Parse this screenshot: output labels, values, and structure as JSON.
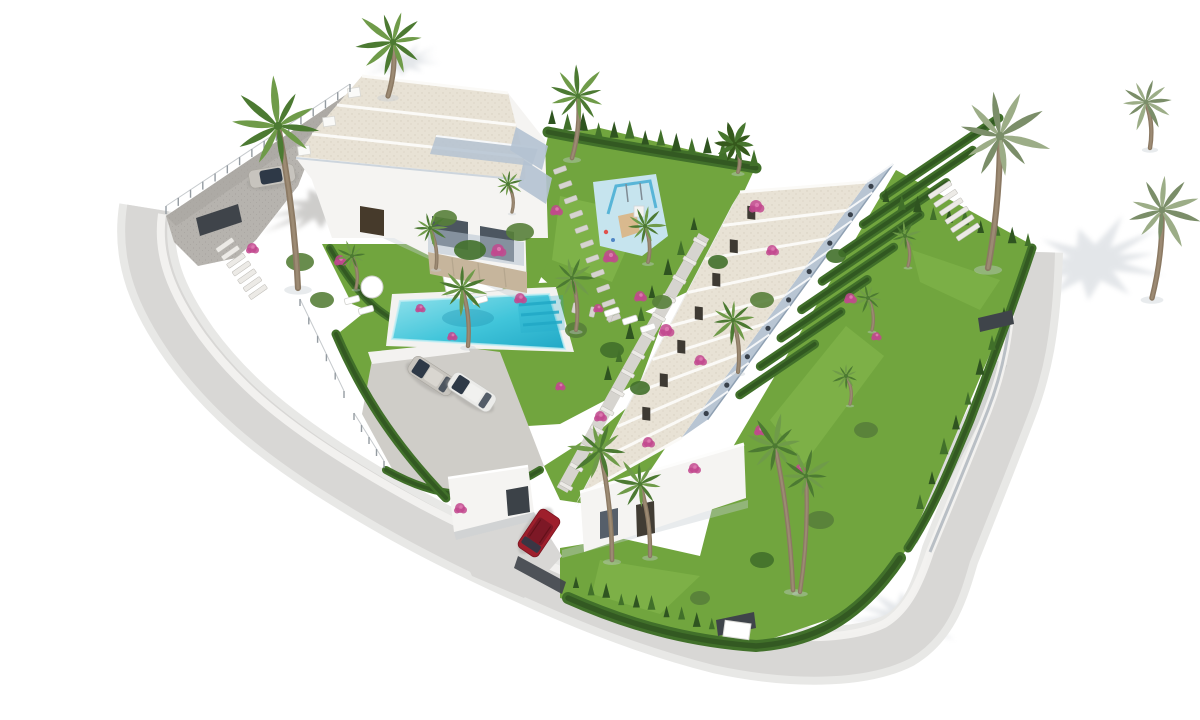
{
  "scene": {
    "type": "architectural-3d-render",
    "description": "Aerial three-quarter view render of a white Mediterranean residential development on an irregular sloping plot surrounded by curved light-grey roads on a pure white background.",
    "background": "#ffffff",
    "lighting": "soft daylight, shadows cast toward the east"
  },
  "objects": {
    "villa_block": {
      "label": "detached villa block",
      "units": 3,
      "roof": "flat sand-gravel roofs",
      "features": [
        "glass balconies",
        "dark entry door",
        "stone retaining wall"
      ]
    },
    "townhouse_row": {
      "label": "terraced townhouse row",
      "units": 9,
      "roof": "sloped sand-gravel roofs",
      "features": [
        "stepped terraces with glass rails",
        "private hedged rear gardens",
        "end gable wall",
        "garage annex"
      ]
    },
    "pool": {
      "label": "communal swimming pool",
      "color": "turquoise",
      "steps": 3,
      "deck": "white"
    },
    "playground": {
      "label": "children's playground",
      "pad_color": "light blue",
      "equipment": [
        "swing frame",
        "wooden tower",
        "slide"
      ]
    },
    "vehicles": [
      {
        "label": "silver sedan",
        "location": "pool parking pad"
      },
      {
        "label": "white sedan",
        "location": "pool parking pad"
      },
      {
        "label": "silver car",
        "location": "upper gravel parking"
      },
      {
        "label": "red SUV",
        "location": "townhouse driveway"
      }
    ],
    "vegetation": {
      "palm_count": 21,
      "cypress_hedges": true,
      "bougainvillea_flowers": true
    },
    "site": {
      "gates": 4,
      "fences": "glass balustrade with posts",
      "parking_areas": 2
    }
  },
  "palette": {
    "bg": "#ffffff",
    "road": "#d8d7d5",
    "road_light": "#e8e8e6",
    "road_dark": "#bfc1c1",
    "curb": "#f3f2f0",
    "wall_line": "#b9bfc5",
    "gravel": "#b6b3ae",
    "gravel_dot": "#a7a49f",
    "pad": "#cfcdc8",
    "wall_white": "#f5f4f2",
    "wall_shade": "#dfdedb",
    "grass": "#71a53e",
    "grass_light": "#8cbf52",
    "grass_dark": "#5c8f33",
    "hedge": "#41702a",
    "hedge_dark": "#2f5420",
    "bush": "#587f3a",
    "roof_sand": "#e8e2d5",
    "roof_dot": "#d7cfc0",
    "roof_edge": "#fbfaf7",
    "eave": "#c3ccd6",
    "terrace": "#b4c2d1",
    "glass": "#8ba0b5",
    "pool_light": "#93e2ec",
    "pool": "#41c5da",
    "pool_deep": "#21a8c6",
    "play_pad": "#c6e4ee",
    "play_frame": "#58b5d7",
    "slide_tan": "#d9b98e",
    "trunk": "#8b7963",
    "trunk_light": "#a8967e",
    "frond": "#6f9b49",
    "frond_dark": "#4c7a32",
    "frond_gray": "#9cad87",
    "frond_gray_dark": "#7b8e69",
    "banana": "#47762e",
    "banana_dark": "#35591c",
    "flower": "#c2488e",
    "flower_light": "#e07ab2",
    "car_silver": "#c7c4be",
    "car_white": "#ebebe9",
    "car_red": "#9e1f2c",
    "car_red_dark": "#7d1826",
    "car_glass": "#2e3947",
    "car_roof": "#d9d6d0",
    "gate": "#3f444a",
    "door": "#463a2b",
    "stone": "#d6d4cf",
    "step_white": "#eceae6",
    "stone_tan": "#c6b59c",
    "shadow": "#c6ccd3",
    "shadow_dark": "#9a9894"
  },
  "geometry": {
    "shadow_stars": [
      {
        "x": 1093,
        "y": 262,
        "rx": 78,
        "ry": 42,
        "rot": -8
      },
      {
        "x": 906,
        "y": 618,
        "rx": 58,
        "ry": 30,
        "rot": 6
      },
      {
        "x": 322,
        "y": 206,
        "rx": 62,
        "ry": 24,
        "rot": -18,
        "dark": true
      },
      {
        "x": 404,
        "y": 62,
        "rx": 40,
        "ry": 15,
        "rot": -12
      }
    ],
    "townhouses": {
      "f0": [
        740,
        192
      ],
      "fstep": [
        -17.5,
        33.5
      ],
      "g0": [
        867,
        182
      ],
      "gstep": [
        -20.6,
        28.4
      ],
      "units": 9,
      "terrace": [
        26,
        -18
      ],
      "doors": 7
    },
    "villa_fascias": [
      [
        [
          362,
          76
        ],
        [
          508,
          93
        ]
      ],
      [
        [
          337,
          105
        ],
        [
          516,
          125
        ]
      ],
      [
        [
          312,
          134
        ],
        [
          524,
          157
        ]
      ],
      [
        [
          296,
          158
        ],
        [
          526,
          181
        ]
      ]
    ],
    "dividers": {
      "start": [
        884,
        196
      ],
      "step": [
        -20.6,
        28.4
      ],
      "n": 8,
      "dir": [
        115,
        -78
      ],
      "shrink": 0.05
    },
    "hedgerows": [
      {
        "d": "M 548,132 C 640,150 700,158 756,168",
        "w": 11
      },
      {
        "d": "M 1032,248 C 1014,302 992,362 970,420 C 950,468 932,512 908,548",
        "w": 9
      },
      {
        "d": "M 568,598 C 640,630 700,642 756,646 C 812,642 858,620 900,558",
        "w": 12
      },
      {
        "d": "M 330,248 C 360,300 382,318 420,332",
        "w": 8
      },
      {
        "d": "M 386,470 C 436,498 482,506 540,470",
        "w": 8
      },
      {
        "d": "M 336,334 C 360,390 392,442 446,498",
        "w": 9
      }
    ],
    "cypress": [
      {
        "a": [
          552,
          126
        ],
        "b": [
          754,
          164
        ],
        "n": 14,
        "s": 10
      },
      {
        "a": [
          886,
          204
        ],
        "b": [
          1028,
          246
        ],
        "n": 10,
        "s": 9
      },
      {
        "a": [
          576,
          590
        ],
        "b": [
          742,
          638
        ],
        "n": 12,
        "s": 8
      },
      {
        "a": [
          1004,
          322
        ],
        "b": [
          920,
          510
        ],
        "n": 8,
        "s": 9
      },
      {
        "a": [
          652,
          300
        ],
        "b": [
          608,
          380
        ],
        "n": 5,
        "s": 9
      },
      {
        "a": [
          694,
          232
        ],
        "b": [
          668,
          276
        ],
        "n": 3,
        "s": 9
      }
    ],
    "stones": [
      {
        "a": [
          560,
          170
        ],
        "b": [
          614,
          318
        ],
        "n": 11,
        "w": 13,
        "h": 5,
        "c": "stone"
      },
      {
        "a": [
          540,
          300
        ],
        "b": [
          610,
          316
        ],
        "n": 5,
        "w": 10,
        "h": 5,
        "c": "stone"
      },
      {
        "a": [
          940,
          190
        ],
        "b": [
          968,
          232
        ],
        "n": 6,
        "w": 26,
        "h": 5,
        "c": "step_white"
      },
      {
        "a": [
          700,
          242
        ],
        "b": [
          566,
          486
        ],
        "n": 14,
        "w": 14,
        "h": 4,
        "c": "step_white"
      },
      {
        "a": [
          225,
          245
        ],
        "b": [
          258,
          292
        ],
        "n": 7,
        "w": 20,
        "h": 5,
        "c": "step_white"
      },
      {
        "a": [
          706,
          286
        ],
        "b": [
          752,
          246
        ],
        "n": 5,
        "w": 12,
        "h": 5,
        "c": "stone"
      }
    ],
    "posts": [
      {
        "a": [
          166,
          214
        ],
        "b": [
          350,
          92
        ],
        "n": 16,
        "h": 8
      },
      {
        "a": [
          354,
          420
        ],
        "b": [
          384,
          468
        ],
        "n": 5,
        "h": 7
      },
      {
        "a": [
          300,
          306
        ],
        "b": [
          344,
          398
        ],
        "n": 6,
        "h": 7
      }
    ],
    "flowers": [
      {
        "x": 498,
        "y": 250,
        "r": 6
      },
      {
        "x": 520,
        "y": 298,
        "r": 5
      },
      {
        "x": 556,
        "y": 210,
        "r": 5
      },
      {
        "x": 610,
        "y": 256,
        "r": 6
      },
      {
        "x": 640,
        "y": 296,
        "r": 5
      },
      {
        "x": 666,
        "y": 330,
        "r": 6
      },
      {
        "x": 700,
        "y": 360,
        "r": 5
      },
      {
        "x": 560,
        "y": 386,
        "r": 4
      },
      {
        "x": 600,
        "y": 416,
        "r": 5
      },
      {
        "x": 648,
        "y": 442,
        "r": 5
      },
      {
        "x": 694,
        "y": 468,
        "r": 5
      },
      {
        "x": 756,
        "y": 206,
        "r": 6
      },
      {
        "x": 772,
        "y": 250,
        "r": 5
      },
      {
        "x": 420,
        "y": 308,
        "r": 4
      },
      {
        "x": 452,
        "y": 336,
        "r": 4
      },
      {
        "x": 760,
        "y": 430,
        "r": 5
      },
      {
        "x": 800,
        "y": 468,
        "r": 4
      },
      {
        "x": 850,
        "y": 298,
        "r": 5
      },
      {
        "x": 876,
        "y": 336,
        "r": 4
      },
      {
        "x": 340,
        "y": 260,
        "r": 5
      },
      {
        "x": 252,
        "y": 248,
        "r": 5
      },
      {
        "x": 460,
        "y": 508,
        "r": 5
      },
      {
        "x": 598,
        "y": 308,
        "r": 4
      }
    ],
    "bushes": [
      {
        "x": 470,
        "y": 250,
        "rx": 16,
        "ry": 10
      },
      {
        "x": 445,
        "y": 218,
        "rx": 12,
        "ry": 8
      },
      {
        "x": 520,
        "y": 232,
        "rx": 14,
        "ry": 9
      },
      {
        "x": 612,
        "y": 350,
        "rx": 12,
        "ry": 8
      },
      {
        "x": 662,
        "y": 302,
        "rx": 10,
        "ry": 7
      },
      {
        "x": 762,
        "y": 300,
        "rx": 12,
        "ry": 8
      },
      {
        "x": 718,
        "y": 262,
        "rx": 10,
        "ry": 7
      },
      {
        "x": 300,
        "y": 262,
        "rx": 14,
        "ry": 9
      },
      {
        "x": 322,
        "y": 300,
        "rx": 12,
        "ry": 8
      },
      {
        "x": 836,
        "y": 256,
        "rx": 10,
        "ry": 7
      },
      {
        "x": 866,
        "y": 430,
        "rx": 12,
        "ry": 8
      },
      {
        "x": 820,
        "y": 520,
        "rx": 14,
        "ry": 9
      },
      {
        "x": 762,
        "y": 560,
        "rx": 12,
        "ry": 8
      },
      {
        "x": 700,
        "y": 598,
        "rx": 10,
        "ry": 7
      },
      {
        "x": 576,
        "y": 330,
        "rx": 11,
        "ry": 8
      },
      {
        "x": 640,
        "y": 388,
        "rx": 10,
        "ry": 7
      }
    ],
    "loungers": [
      {
        "x": 352,
        "y": 300,
        "rot": -15
      },
      {
        "x": 366,
        "y": 310,
        "rot": -15
      },
      {
        "x": 612,
        "y": 312,
        "rot": -18
      },
      {
        "x": 630,
        "y": 320,
        "rot": -18
      },
      {
        "x": 648,
        "y": 328,
        "rot": -18
      },
      {
        "x": 480,
        "y": 300,
        "rot": -15
      }
    ],
    "palms": [
      {
        "x": 393,
        "y": 42,
        "r": 36,
        "tx": 388,
        "ty": 96,
        "v": "green"
      },
      {
        "x": 278,
        "y": 126,
        "r": 46,
        "tx": 298,
        "ty": 288,
        "v": "green"
      },
      {
        "x": 578,
        "y": 96,
        "r": 30,
        "tx": 572,
        "ty": 158,
        "v": "green"
      },
      {
        "x": 645,
        "y": 226,
        "r": 20,
        "tx": 648,
        "ty": 262,
        "v": "green"
      },
      {
        "x": 572,
        "y": 278,
        "r": 22,
        "tx": 576,
        "ty": 330,
        "v": "green"
      },
      {
        "x": 462,
        "y": 288,
        "r": 26,
        "tx": 468,
        "ty": 346,
        "v": "green"
      },
      {
        "x": 733,
        "y": 320,
        "r": 24,
        "tx": 738,
        "ty": 372,
        "v": "green"
      },
      {
        "x": 600,
        "y": 450,
        "r": 30,
        "tx": 612,
        "ty": 560,
        "v": "green"
      },
      {
        "x": 640,
        "y": 484,
        "r": 26,
        "tx": 650,
        "ty": 556,
        "v": "green"
      },
      {
        "x": 775,
        "y": 446,
        "r": 30,
        "tx": 793,
        "ty": 590,
        "v": "green"
      },
      {
        "x": 806,
        "y": 476,
        "r": 26,
        "tx": 800,
        "ty": 592,
        "v": "green"
      },
      {
        "x": 1000,
        "y": 136,
        "r": 47,
        "tx": 988,
        "ty": 268,
        "v": "gray"
      },
      {
        "x": 1162,
        "y": 210,
        "r": 38,
        "tx": 1152,
        "ty": 298,
        "v": "gray"
      },
      {
        "x": 1146,
        "y": 102,
        "r": 27,
        "tx": 1150,
        "ty": 148,
        "v": "gray"
      },
      {
        "x": 868,
        "y": 298,
        "r": 15,
        "tx": 872,
        "ty": 330,
        "v": "green"
      },
      {
        "x": 846,
        "y": 376,
        "r": 14,
        "tx": 850,
        "ty": 404,
        "v": "green"
      },
      {
        "x": 352,
        "y": 256,
        "r": 15,
        "tx": 356,
        "ty": 288,
        "v": "green"
      },
      {
        "x": 735,
        "y": 144,
        "r": 22,
        "tx": 738,
        "ty": 172,
        "v": "banana"
      },
      {
        "x": 905,
        "y": 236,
        "r": 15,
        "tx": 908,
        "ty": 266,
        "v": "green"
      },
      {
        "x": 508,
        "y": 184,
        "r": 14,
        "tx": 512,
        "ty": 212,
        "v": "green"
      },
      {
        "x": 430,
        "y": 228,
        "r": 18,
        "tx": 436,
        "ty": 268,
        "v": "green"
      }
    ]
  }
}
